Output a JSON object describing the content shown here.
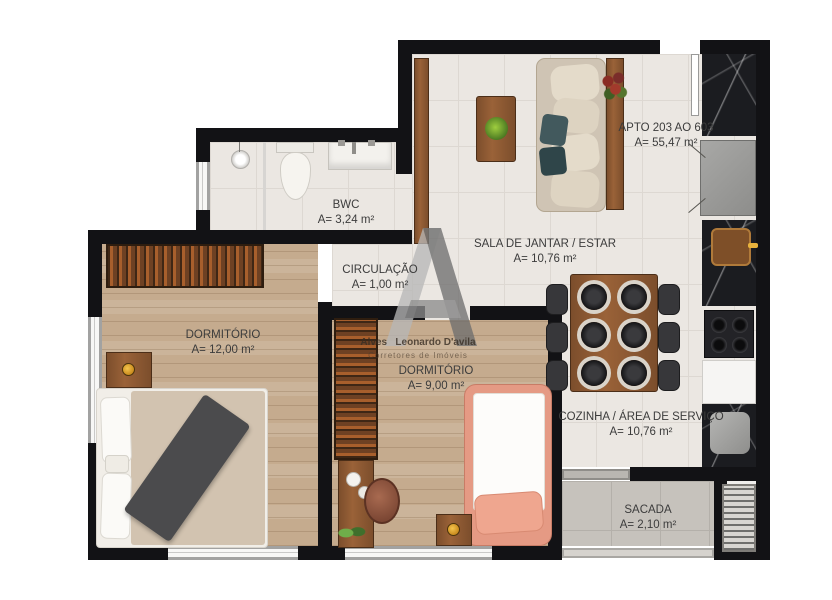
{
  "plan": {
    "apto_label": "APTO 203 AO 603",
    "apto_area": "A= 55,47 m²",
    "rooms": [
      {
        "name": "BWC",
        "area": "A= 3,24 m²"
      },
      {
        "name": "CIRCULAÇÃO",
        "area": "A= 1,00 m²"
      },
      {
        "name": "DORMITÓRIO",
        "area": "A= 12,00 m²"
      },
      {
        "name": "DORMITÓRIO",
        "area": "A= 9,00 m²"
      },
      {
        "name": "SALA DE JANTAR / ESTAR",
        "area": "A= 10,76 m²"
      },
      {
        "name": "COZINHA / ÁREA DE SERVIÇO",
        "area": "A= 10,76 m²"
      },
      {
        "name": "SACADA",
        "area": "A= 2,10 m²"
      }
    ]
  },
  "watermark": {
    "logo": "A-monogram",
    "name_1": "Alves",
    "name_2": "Leonardo D'avila",
    "subtitle": "Corretores de Imóveis"
  },
  "colors": {
    "wall": "#121215",
    "tile_floor": "#ebe7e2",
    "wood_floor": "#c5ab8e",
    "balcony_floor": "#c6c2bc",
    "counter_marble": "#1b1c20",
    "bed2_accent": "#e59a84",
    "sofa": "#d9cec0",
    "teal_pillow": "#42595d",
    "gold_knob": "#e8b23c"
  }
}
